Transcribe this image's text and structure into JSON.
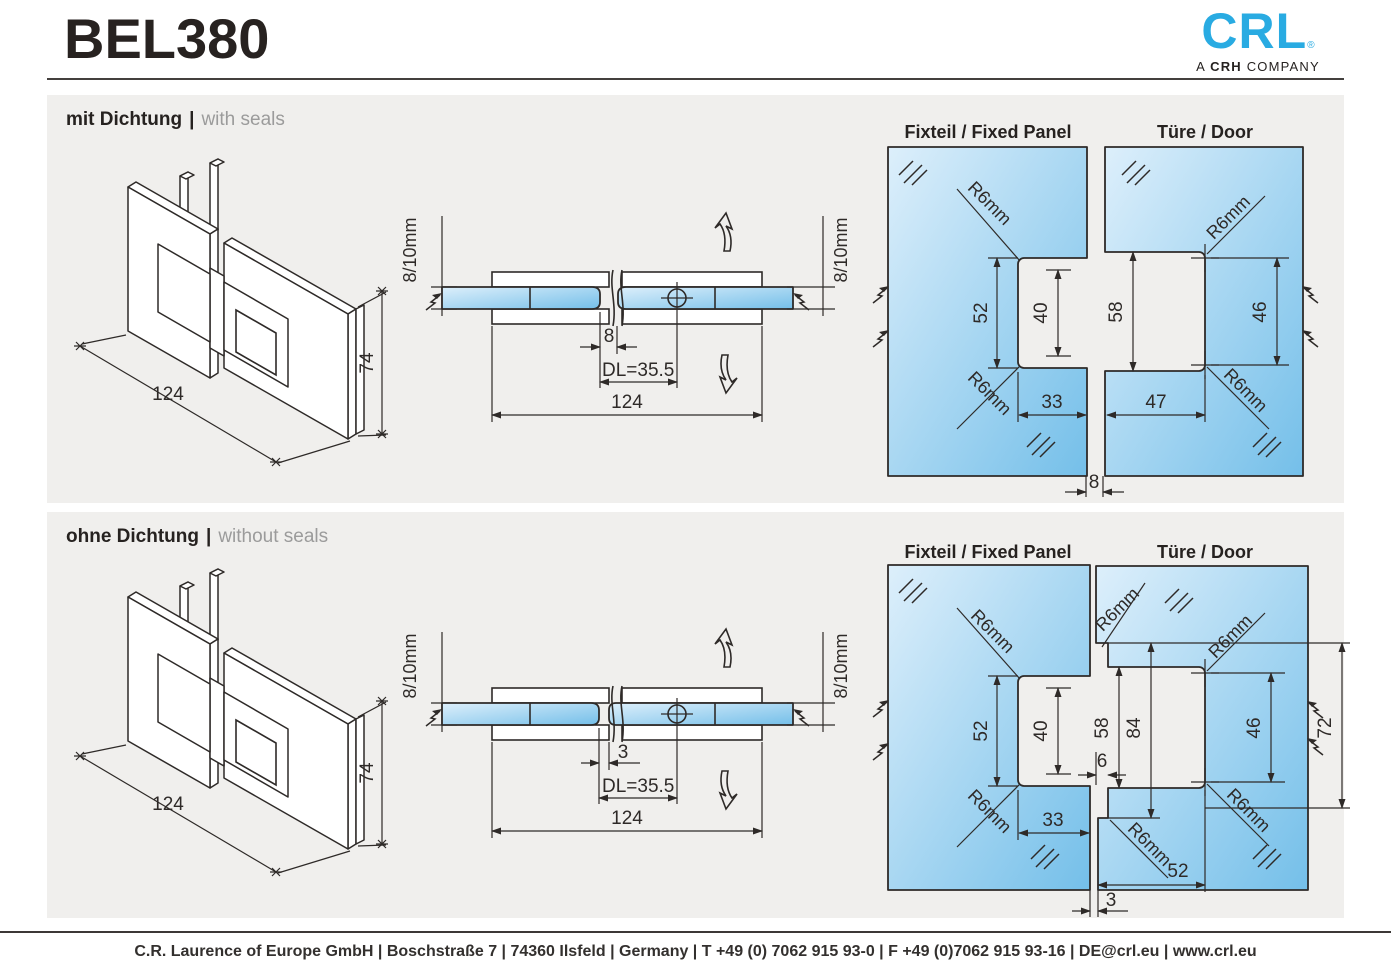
{
  "header": {
    "title": "BEL380"
  },
  "logo": {
    "brand": "CRL",
    "registered": "®",
    "sub_prefix": "A",
    "sub_bold": "CRH",
    "sub_suffix": "COMPANY"
  },
  "colors": {
    "accent_blue": "#29abe2",
    "line": "#2e2a28",
    "panel_bg": "#f0efed",
    "glass_light": "#ddeffb",
    "glass_dark": "#74bfe9",
    "muted_text": "#9b9b9b"
  },
  "sections": [
    {
      "heading": {
        "de": "mit Dichtung",
        "divider": "|",
        "en": "with seals"
      },
      "iso": {
        "width": "124",
        "height": "74"
      },
      "cross": {
        "left_glass": "8/10mm",
        "right_glass": "8/10mm",
        "gap": "8",
        "dl": "DL=35.5",
        "overall": "124"
      },
      "panels": {
        "fixed_title": "Fixteil / Fixed Panel",
        "door_title": "Türe / Door",
        "r6_fixed_top": "R6mm",
        "r6_fixed_bottom": "R6mm",
        "r6_door_top": "R6mm",
        "r6_door_bottom": "R6mm",
        "fixed_height": "52",
        "fixed_inner": "40",
        "fixed_width": "33",
        "door_height": "58",
        "door_inner": "46",
        "door_width": "47",
        "gap": "8"
      }
    },
    {
      "heading": {
        "de": "ohne Dichtung",
        "divider": "|",
        "en": "without seals"
      },
      "iso": {
        "width": "124",
        "height": "74"
      },
      "cross": {
        "left_glass": "8/10mm",
        "right_glass": "8/10mm",
        "gap": "3",
        "dl": "DL=35.5",
        "overall": "124"
      },
      "panels": {
        "fixed_title": "Fixteil / Fixed Panel",
        "door_title": "Türe / Door",
        "r6_fixed_top": "R6mm",
        "r6_fixed_bottom": "R6mm",
        "r6_door_step": "R6mm",
        "r6_door_top": "R6mm",
        "r6_door_bottom": "R6mm",
        "r6_door_inner": "R6mm",
        "fixed_height": "52",
        "fixed_inner": "40",
        "fixed_width": "33",
        "door_height": "58",
        "door_outer_height": "84",
        "door_inner": "46",
        "door_edge": "72",
        "door_step": "6",
        "door_bottom_width": "52",
        "gap": "3"
      }
    }
  ],
  "footer": {
    "info": "C.R. Laurence of Europe GmbH | Boschstraße 7 | 74360 Ilsfeld | Germany | T +49 (0) 7062 915 93-0 | F +49 (0)7062 915 93-16 | DE@crl.eu | www.crl.eu"
  }
}
